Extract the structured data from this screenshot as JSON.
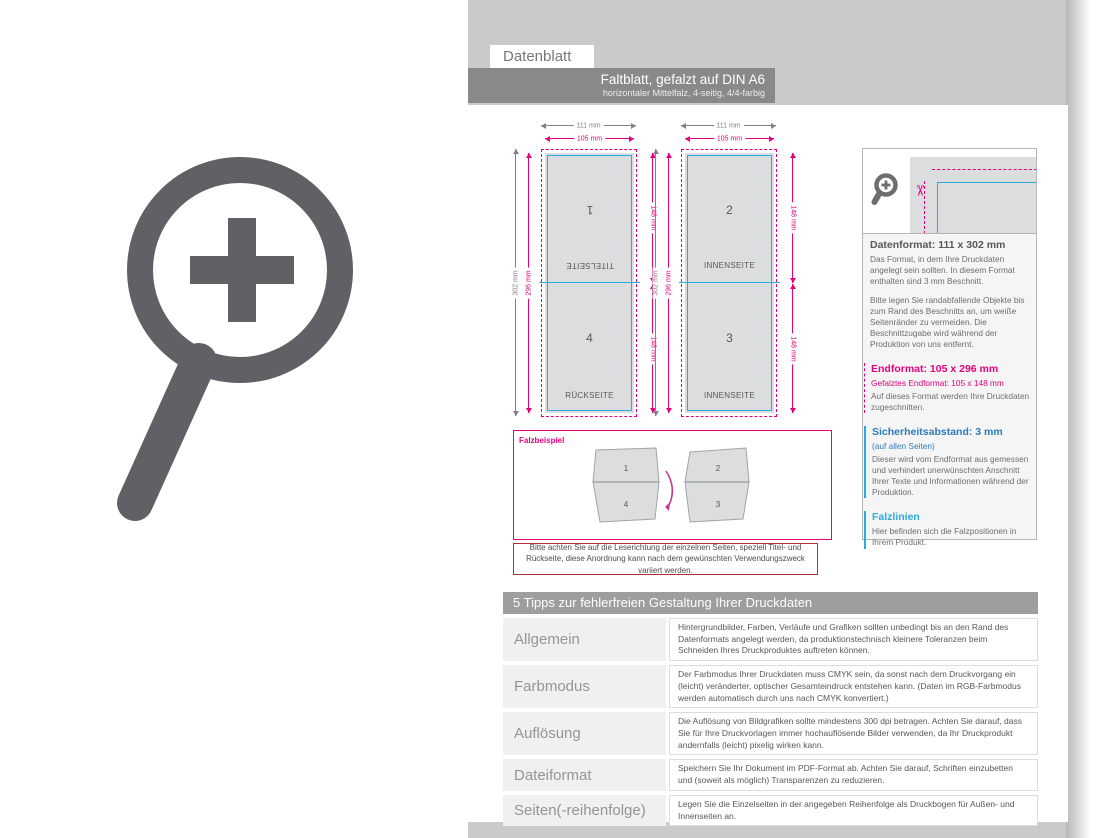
{
  "header": {
    "datenblatt_label": "Datenblatt",
    "title": "Faltblatt, gefalzt auf DIN A6",
    "subtitle": "horizontaler Mittelfalz, 4-seitig, 4/4-farbig"
  },
  "diagram": {
    "dims": {
      "outer_width": "111 mm",
      "inner_width": "105 mm",
      "outer_height": "302 mm",
      "inner_height": "296 mm",
      "half_height": "148 mm"
    },
    "pages": [
      {
        "number": "1",
        "label": "TITELSEITE"
      },
      {
        "number": "2",
        "label": "INNENSEITE"
      },
      {
        "number": "3",
        "label": "INNENSEITE"
      },
      {
        "number": "4",
        "label": "RÜCKSEITE"
      }
    ]
  },
  "info_panel": {
    "datenformat": {
      "title": "Datenformat: 111 x 302 mm",
      "p1": "Das Format, in dem Ihre Druckdaten angelegt sein sollten. In diesem Format enthalten sind 3 mm Beschnitt.",
      "p2": "Bitte legen Sie randabfallende Objekte bis zum Rand des Beschnitts an, um weiße Seitenränder zu vermeiden. Die Beschnittzugabe wird während der Produktion von uns entfernt."
    },
    "endformat": {
      "title": "Endformat: 105 x 296 mm",
      "subtitle": "Gefalztes Endformat: 105 x 148 mm",
      "body": "Auf dieses Format werden Ihre Druckdaten zugeschnitten."
    },
    "sicherheitsabstand": {
      "title": "Sicherheitsabstand: 3 mm",
      "subtitle": "(auf allen Seiten)",
      "body": "Dieser wird vom Endformat aus gemessen und verhindert unerwünschten Anschnitt Ihrer Texte und Informationen während der Produktion."
    },
    "falzlinien": {
      "title": "Falzlinien",
      "body": "Hier befinden sich die Falzpositionen in Ihrem Produkt."
    }
  },
  "falzbeispiel": {
    "label": "Falzbeispiel",
    "sheet1": {
      "top": "1",
      "bottom": "4"
    },
    "sheet2": {
      "top": "2",
      "bottom": "3"
    }
  },
  "note": "Bitte achten Sie auf die Leserichtung der einzelnen Seiten, speziell Titel- und Rückseite, diese Anordnung kann nach dem gewünschten Verwendungszweck variiert werden.",
  "tips": {
    "title": "5 Tipps zur fehlerfreien Gestaltung Ihrer Druckdaten",
    "rows": [
      {
        "label": "Allgemein",
        "text": "Hintergrundbilder, Farben, Verläufe und Grafiken sollten unbedingt bis an den Rand des Datenformats angelegt werden, da produktionstechnisch kleinere Toleranzen beim Schneiden Ihres Druckproduktes auftreten können."
      },
      {
        "label": "Farbmodus",
        "text": "Der Farbmodus Ihrer Druckdaten muss CMYK sein, da sonst nach dem Druckvorgang ein (leicht) veränderter, optischer Gesamteindruck entstehen kann. (Daten im RGB-Farbmodus werden automatisch durch uns nach CMYK konvertiert.)"
      },
      {
        "label": "Auflösung",
        "text": "Die Auflösung von Bildgrafiken sollte mindestens 300 dpi betragen. Achten Sie darauf, dass Sie für Ihre Druckvorlagen immer hochauflösende Bilder verwenden, da Ihr Druckprodukt andernfalls (leicht) pixelig wirken kann."
      },
      {
        "label": "Dateiformat",
        "text": "Speichern Sie Ihr Dokument im PDF-Format ab. Achten Sie darauf, Schriften einzubetten und (soweit als möglich) Transparenzen zu reduzieren."
      },
      {
        "label": "Seiten(-reihenfolge)",
        "text": "Legen Sie die Einzelseiten in der angegeben Reihenfolge als Druckbogen für Außen- und Innenseiten an."
      }
    ]
  },
  "colors": {
    "magenta_bleed": "#e6007e",
    "blue_safety": "#29abe2",
    "blue_heading": "#2b7bbb",
    "panel_gray": "#dcdddf",
    "header_bar_gray": "#88898b",
    "tips_bar_gray": "#9d9ea0",
    "note_border_red": "#b23137",
    "icon_gray": "#606164"
  }
}
